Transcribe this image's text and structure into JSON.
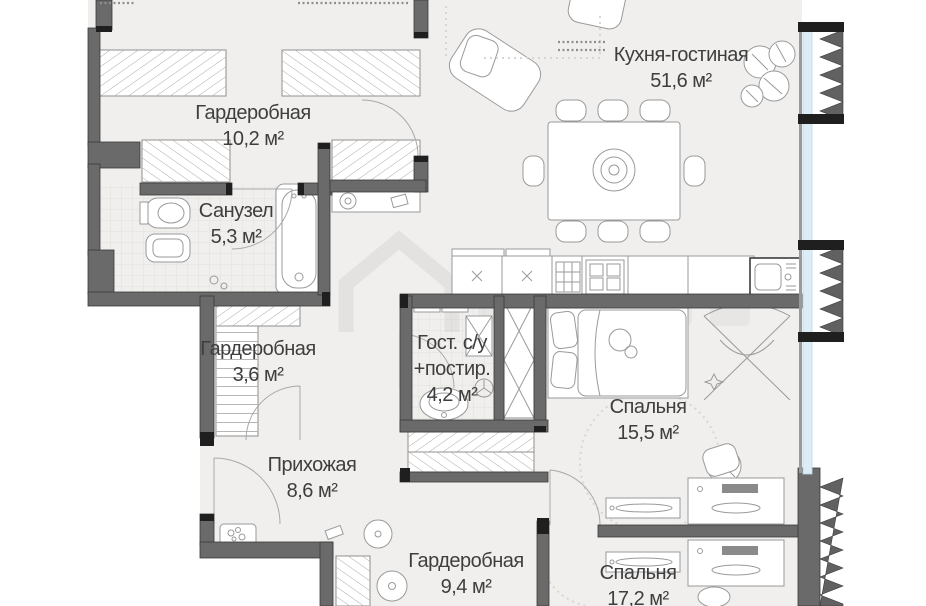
{
  "plan_type": "apartment-floor-plan",
  "rooms": [
    {
      "id": "kitchen-living",
      "name": "Кухня-гостиная",
      "area": "51,6 м²"
    },
    {
      "id": "wardrobe-1",
      "name": "Гардеробная",
      "area": "10,2 м²"
    },
    {
      "id": "bathroom",
      "name": "Санузел",
      "area": "5,3 м²"
    },
    {
      "id": "wardrobe-2",
      "name": "Гардеробная",
      "area": "3,6 м²"
    },
    {
      "id": "guest-wc",
      "name": "Гост. с/у",
      "name2": "+постир.",
      "area": "4,2 м²"
    },
    {
      "id": "bedroom-1",
      "name": "Спальня",
      "area": "15,5 м²"
    },
    {
      "id": "hallway",
      "name": "Прихожая",
      "area": "8,6 м²"
    },
    {
      "id": "wardrobe-3",
      "name": "Гардеробная",
      "area": "9,4 м²"
    },
    {
      "id": "bedroom-2",
      "name": "Спальня",
      "area": "17,2 м²"
    }
  ],
  "watermark": {
    "icon": "house-logo-watermark"
  },
  "colors": {
    "wall": "#6a6a6a",
    "wall_dark": "#1f1f1f",
    "floor": "#f0efed",
    "furniture_line": "#9a9a9a",
    "glazing_blue": "#dcedf6",
    "text": "#3e3e3e"
  }
}
